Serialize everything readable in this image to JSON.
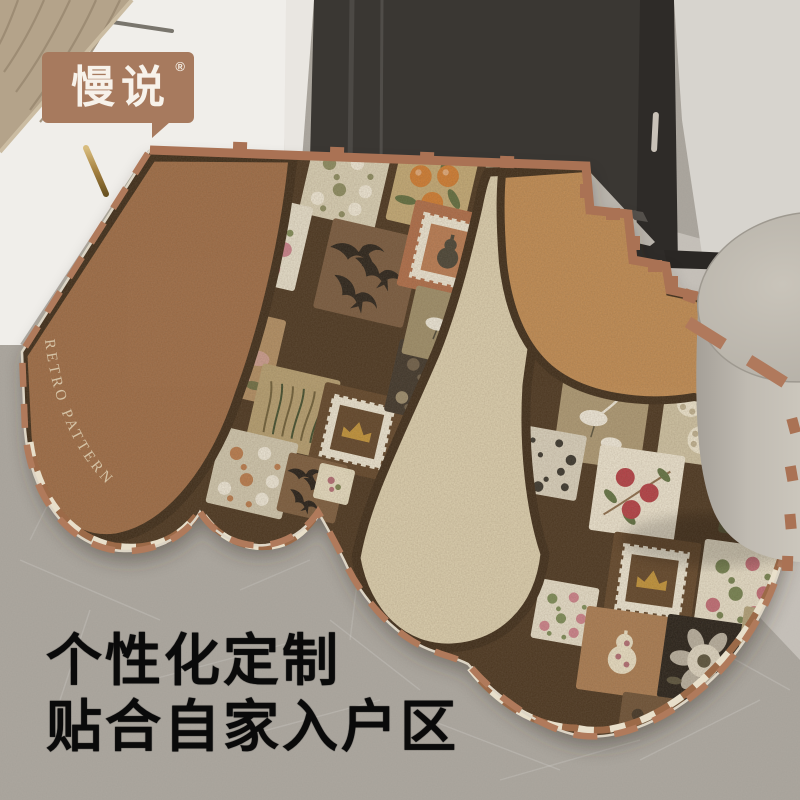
{
  "brand": {
    "logo_text": "慢说",
    "registered_mark": "®",
    "badge_color": "#a77a5e",
    "badge_text_color": "#f7f2ea"
  },
  "headline": {
    "line1": "个性化定制",
    "line2": "贴合自家入户区",
    "color": "#0a0a0a"
  },
  "mat": {
    "curved_label": "RETRO PATTERN",
    "label_color": "#dccdb0",
    "colors": {
      "base_dark": "#46301d",
      "brown": "#9d6a43",
      "cream": "#dbcead",
      "caramel": "#c08a50",
      "dash": "#b07a5b",
      "band": "#aa7254",
      "trim_light": "#e8dfca",
      "trim_brown": "#9c6a48",
      "edge_light": "#ddd5c5",
      "border_dark": "#3a2815"
    },
    "cells": [
      {
        "x": 345,
        "y": 183,
        "s": 78,
        "r": 13,
        "bg": "#d8cfb4",
        "t": "flowers",
        "a": "#efe8d6",
        "b": "#8a8a5e"
      },
      {
        "x": 432,
        "y": 190,
        "s": 78,
        "r": 13,
        "bg": "#c2a873",
        "t": "oranges",
        "a": "#cf7a2e",
        "b": "#5d6b3c"
      },
      {
        "x": 262,
        "y": 240,
        "s": 86,
        "r": 13,
        "bg": "#e6dfcb",
        "t": "flowers",
        "a": "#c97f8a",
        "b": "#7d8a55"
      },
      {
        "x": 368,
        "y": 273,
        "s": 92,
        "r": 13,
        "bg": "#76573b",
        "t": "birds",
        "a": "#241d15",
        "b": "#e8dfc8"
      },
      {
        "x": 449,
        "y": 252,
        "s": 88,
        "r": 13,
        "bg": "#ad6a45",
        "t": "stamp",
        "a": "#454032",
        "b": "#b8794f"
      },
      {
        "x": 235,
        "y": 353,
        "s": 86,
        "r": 13,
        "bg": "#b08c60",
        "t": "peony",
        "a": "#cf9d97",
        "b": "#6b6b40"
      },
      {
        "x": 293,
        "y": 411,
        "s": 80,
        "r": 13,
        "bg": "#b49d6e",
        "t": "grass",
        "a": "#3d4a2a",
        "b": "#6b5b35"
      },
      {
        "x": 357,
        "y": 432,
        "s": 84,
        "r": 13,
        "bg": "#5e4226",
        "t": "stampc",
        "a": "#c09136",
        "b": "#6b4a28"
      },
      {
        "x": 252,
        "y": 473,
        "s": 78,
        "r": 13,
        "bg": "#cfc6ad",
        "t": "flowers",
        "a": "#eee8d8",
        "b": "#b8794a"
      },
      {
        "x": 312,
        "y": 488,
        "s": 60,
        "r": 13,
        "bg": "#7a5a3b",
        "t": "birds",
        "a": "#1f1913",
        "b": "#e8dfc8"
      },
      {
        "x": 334,
        "y": 484,
        "s": 36,
        "r": 13,
        "bg": "#e3dabd",
        "t": "medallion",
        "a": "#b06a72",
        "b": "#77804d"
      },
      {
        "x": 428,
        "y": 383,
        "s": 74,
        "r": 13,
        "bg": "#3a3126",
        "t": "flowers",
        "a": "#9a8a6a",
        "b": "#6b5b45"
      },
      {
        "x": 443,
        "y": 327,
        "s": 70,
        "r": 13,
        "bg": "#9c8c66",
        "t": "crane",
        "a": "#ece7d8",
        "b": "#4a4433"
      },
      {
        "x": 512,
        "y": 187,
        "s": 60,
        "r": 13,
        "bg": "#c3b290",
        "t": "flowers",
        "a": "#d8cfb5",
        "b": "#8a7a52"
      },
      {
        "x": 602,
        "y": 421,
        "s": 88,
        "r": 8,
        "bg": "#ab9771",
        "t": "crane",
        "a": "#efe9da",
        "b": "#57503a"
      },
      {
        "x": 706,
        "y": 421,
        "s": 88,
        "r": 8,
        "bg": "#cdc1a1",
        "t": "hydrangea",
        "a": "#ece4cd",
        "b": "#97835b"
      },
      {
        "x": 763,
        "y": 498,
        "s": 80,
        "r": 8,
        "bg": "#4b492b",
        "t": "oranges",
        "a": "#d2802e",
        "b": "#2f3a22"
      },
      {
        "x": 637,
        "y": 493,
        "s": 86,
        "r": 8,
        "bg": "#ebe3cf",
        "t": "pome",
        "a": "#b23b42",
        "b": "#5e7040"
      },
      {
        "x": 549,
        "y": 463,
        "s": 66,
        "r": 10,
        "bg": "#d8d0bc",
        "t": "blobs",
        "a": "#23201a",
        "b": "#57503a"
      },
      {
        "x": 652,
        "y": 581,
        "s": 88,
        "r": 8,
        "bg": "#5e4226",
        "t": "stampc",
        "a": "#c09136",
        "b": "#6b4a28"
      },
      {
        "x": 741,
        "y": 586,
        "s": 84,
        "r": 8,
        "bg": "#e6dec8",
        "t": "flowers",
        "a": "#c06a74",
        "b": "#72804e"
      },
      {
        "x": 565,
        "y": 613,
        "s": 60,
        "r": 10,
        "bg": "#e5ddc8",
        "t": "flowers",
        "a": "#cb7f89",
        "b": "#7a8a55"
      },
      {
        "x": 623,
        "y": 653,
        "s": 84,
        "r": 8,
        "bg": "#a97a4f",
        "t": "gourd",
        "a": "#e9dfc4",
        "b": "#b06a72"
      },
      {
        "x": 704,
        "y": 661,
        "s": 84,
        "r": 8,
        "bg": "#221c15",
        "t": "peony",
        "a": "#ddd5c2",
        "b": "#57503a"
      },
      {
        "x": 771,
        "y": 641,
        "s": 62,
        "r": 8,
        "bg": "#b0a078",
        "t": "blobs",
        "a": "#2a2318",
        "b": "#57503a"
      },
      {
        "x": 653,
        "y": 731,
        "s": 70,
        "r": 8,
        "bg": "#6b4f33",
        "t": "flowers",
        "a": "#caa86a",
        "b": "#3f3222"
      }
    ]
  },
  "scene": {
    "floor": "#a6a199",
    "floor_light": "#c4c0b8",
    "floor_dark": "#908b84",
    "door": "#3a3733",
    "door_edge": "#2e2b28",
    "wall": "#d7d4ce",
    "bench": "#f0eeea",
    "cushion": "#b4a38a",
    "ottoman": "#bcb7ad",
    "handle": "#ab8a50"
  }
}
